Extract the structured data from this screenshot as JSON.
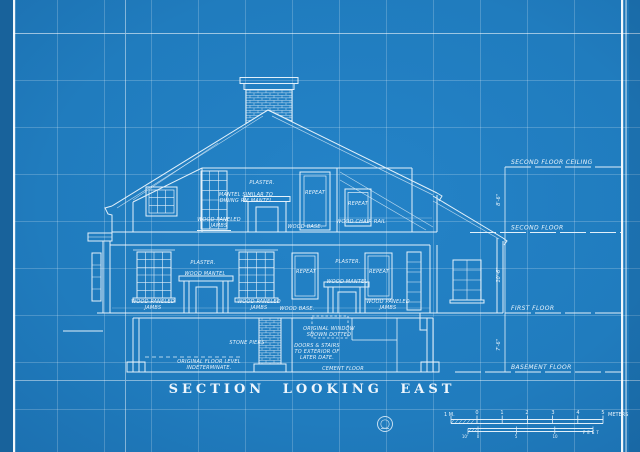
{
  "page": {
    "title": "SECTION LOOKING EAST"
  },
  "colors": {
    "background": "#2180c2",
    "paper_edge_dark": "#18629b",
    "line": "#f5fbff",
    "grid": "rgba(255,255,255,0.2)"
  },
  "floor_refs": {
    "second_floor_ceiling": "SECOND FLOOR CEILING",
    "second_floor": "SECOND FLOOR",
    "first_floor": "FIRST FLOOR",
    "basement_floor": "BASEMENT FLOOR"
  },
  "dims": {
    "ceiling_to_second": "8'-6\"",
    "second_to_first": "10'-6\"",
    "first_to_basement": "7'-6\""
  },
  "attic": {
    "plaster": "PLASTER.",
    "mantel_note_1": "MANTEL SIMILAR TO",
    "mantel_note_2": "DINING RM MANTEL",
    "repeat_a": "REPEAT",
    "repeat_b": "REPEAT",
    "jambs_1": "WOOD PANELED",
    "jambs_2": "JAMBS",
    "base": "WOOD BASE.",
    "chair_rail": "WOOD CHAIR RAIL"
  },
  "first_floor": {
    "plaster_left": "PLASTER.",
    "mantel_left": "WOOD MANTEL",
    "jambs_left_1": "WOOD PANELED",
    "jambs_left_2": "JAMBS",
    "jambs_mid_1": "WOOD PANELED",
    "jambs_mid_2": "JAMBS",
    "plaster_right": "PLASTER.",
    "repeat_a": "REPEAT",
    "mantel_right": "WOOD MANTEL",
    "repeat_b": "REPEAT",
    "base": "WOOD BASE.",
    "jambs_right_1": "WOOD PANELED",
    "jambs_right_2": "JAMBS"
  },
  "basement": {
    "stone_piers": "STONE PIERS",
    "window_note_1": "ORIGINAL WINDOW",
    "window_note_2": "SHOWN DOTTED",
    "doors_note_1": "DOORS & STAIRS",
    "doors_note_2": "TO EXTERIOR OF",
    "doors_note_3": "LATER DATE.",
    "floor_note_1": "ORIGINAL FLOOR LEVEL",
    "floor_note_2": "INDETERMINATE.",
    "cement_floor": "CEMENT FLOOR"
  },
  "scale": {
    "meters_left": "1 M.",
    "meters_ticks": [
      "0",
      "1",
      "2",
      "3",
      "4",
      "5"
    ],
    "meters_unit": "METERS",
    "feet_left": "10'",
    "feet_ticks": [
      "0",
      "5",
      "10"
    ],
    "feet_unit": "FEET"
  }
}
